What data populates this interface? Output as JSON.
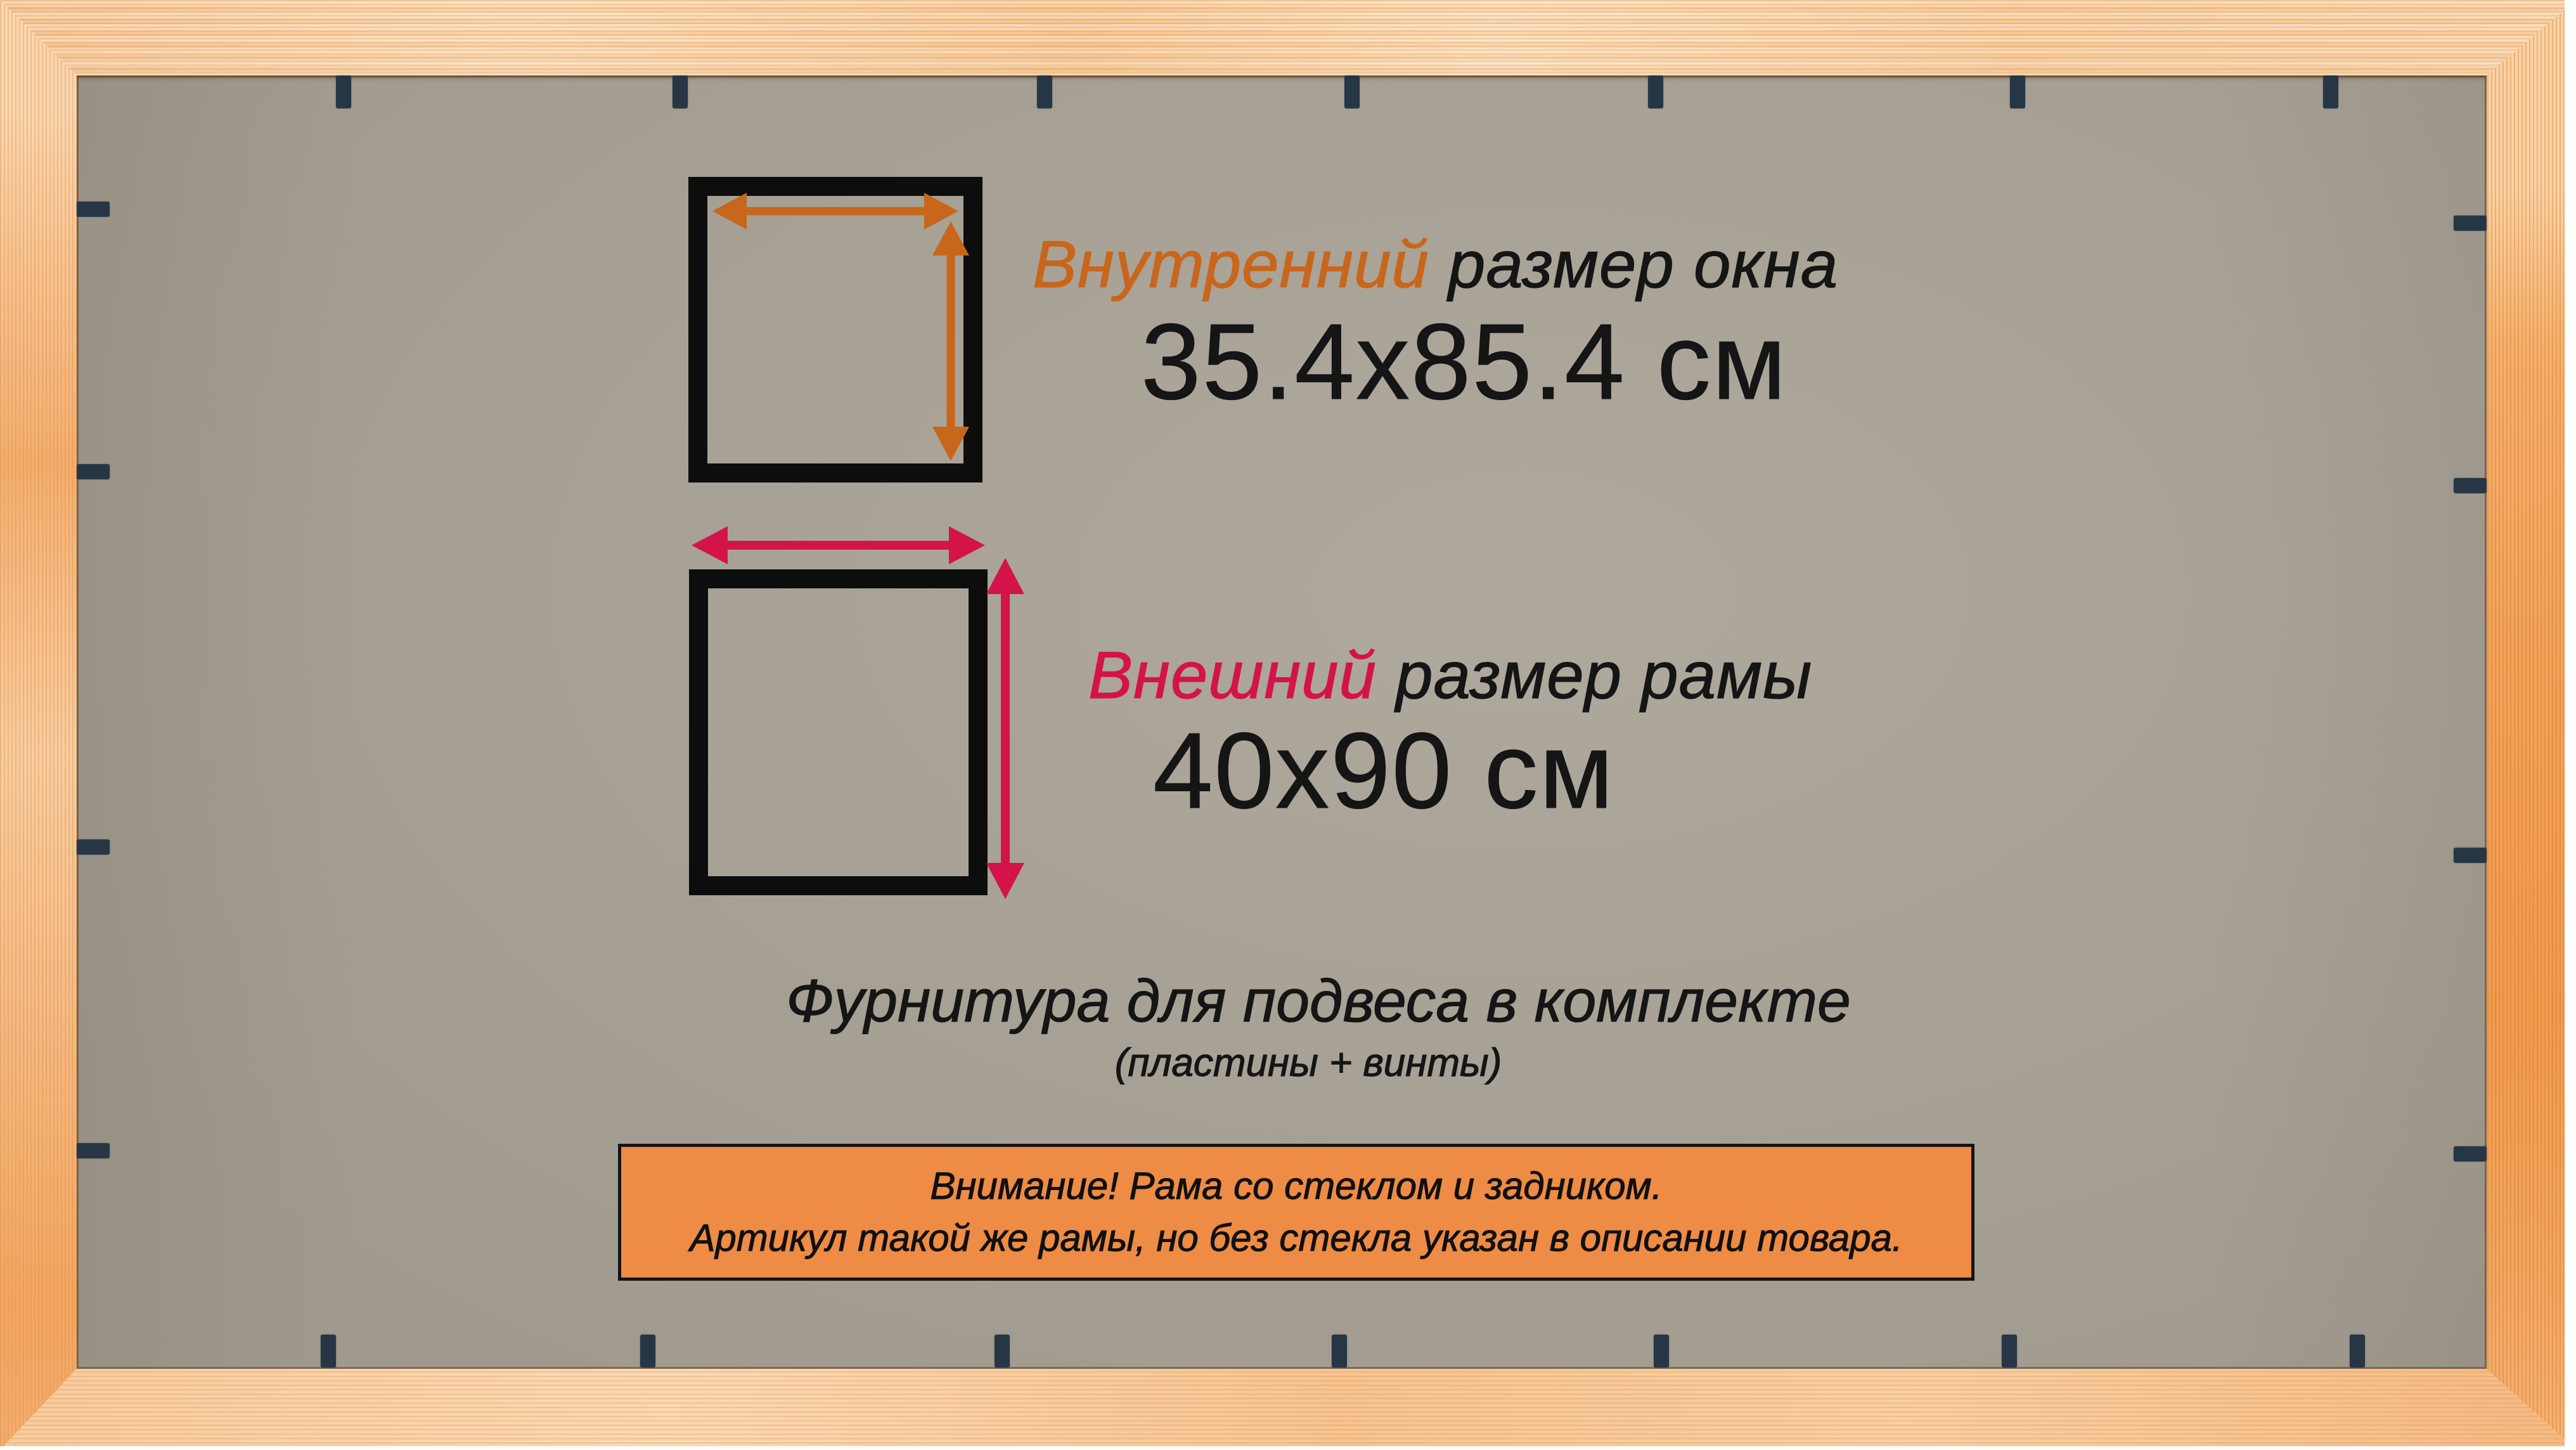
{
  "labels": {
    "inner_title_accent": "Внутренний",
    "inner_title_rest": " размер окна",
    "inner_size": "35.4x85.4 см",
    "outer_title_accent": "Внешний",
    "outer_title_rest": " размер рамы",
    "outer_size": "40x90 см",
    "hardware_line1": "Фурнитура для подвеса в комплекте",
    "hardware_line2": "(пластины + винты)",
    "notice_line1": "Внимание! Рама со стеклом и задником.",
    "notice_line2": "Артикул такой же рамы, но без стекла указан в описании товара."
  },
  "colors": {
    "accent_inner": "#c8661c",
    "accent_outer": "#d4134a",
    "banner_fill": "#ee8b44",
    "banner_border": "#141414",
    "backing_gray": "#a9a296",
    "clip_dark": "#263644",
    "square_black": "#0d0d0d",
    "text_ink": "#151515"
  }
}
